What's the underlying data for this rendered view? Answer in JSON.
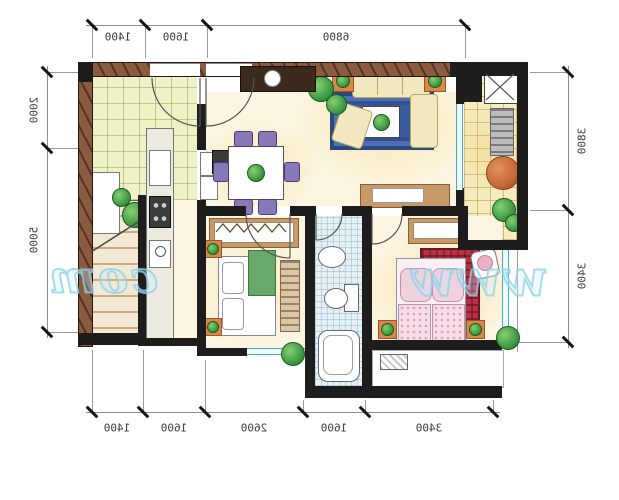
{
  "dimensions": {
    "top": [
      "1400",
      "1600",
      "6800"
    ],
    "bottom": [
      "1400",
      "1600",
      "2600",
      "1600",
      "3400"
    ],
    "left": [
      "2000",
      "5000"
    ],
    "right": [
      "3800",
      "3400"
    ]
  },
  "watermark": {
    "left_text": "com",
    "right_text": "www"
  },
  "colors": {
    "wall_black": "#1d1d1d",
    "wall_wood": "#8a5c42",
    "rug_blue": "#3a5a9e",
    "bed_red": "#b63244",
    "plant_green": "#3f9c45",
    "pot_orange": "#d9884a",
    "window_teal": "#46acc2",
    "watermark_blue": "#8ed2e9",
    "dim_text": "#3c3c3c"
  }
}
